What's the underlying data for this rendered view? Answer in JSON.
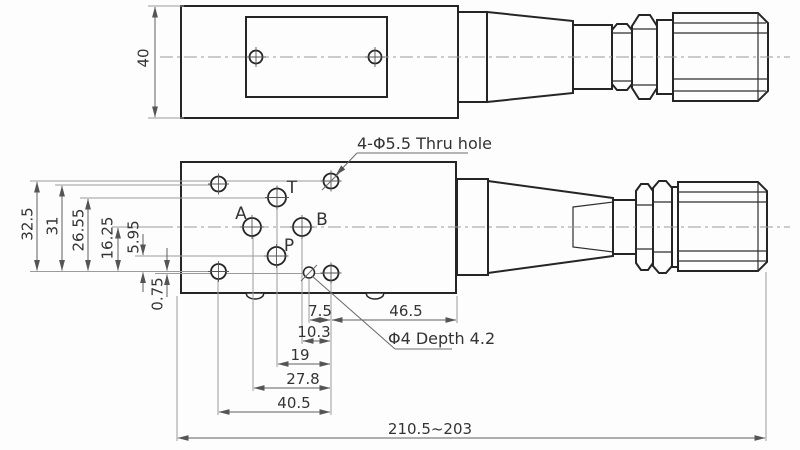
{
  "drawing": {
    "kind": "valve-engineering-drawing",
    "top_view": {
      "height_dim": "40"
    },
    "front_view": {
      "ports": {
        "t": "T",
        "a": "A",
        "b": "B",
        "p": "P"
      },
      "vertical_dims": {
        "d32_5": "32.5",
        "d31": "31",
        "d26_55": "26.55",
        "d16_25": "16.25",
        "d5_95": "5.95",
        "d0_75": "0.75"
      },
      "bottom_dims": {
        "d7_5": "7.5",
        "d46_5": "46.5",
        "d10_3": "10.3",
        "d19": "19",
        "d27_8": "27.8",
        "d40_5": "40.5"
      },
      "overall_dim": "210.5~203",
      "annotations": {
        "thru_hole": "4-Φ5.5  Thru hole",
        "depth_hole": "Φ4 Depth 4.2"
      }
    },
    "colors": {
      "outline": "#252525",
      "dimension_line": "#606060",
      "extension_line": "#9b9b9b",
      "text": "#333333",
      "background": "#fdfdfd"
    }
  }
}
